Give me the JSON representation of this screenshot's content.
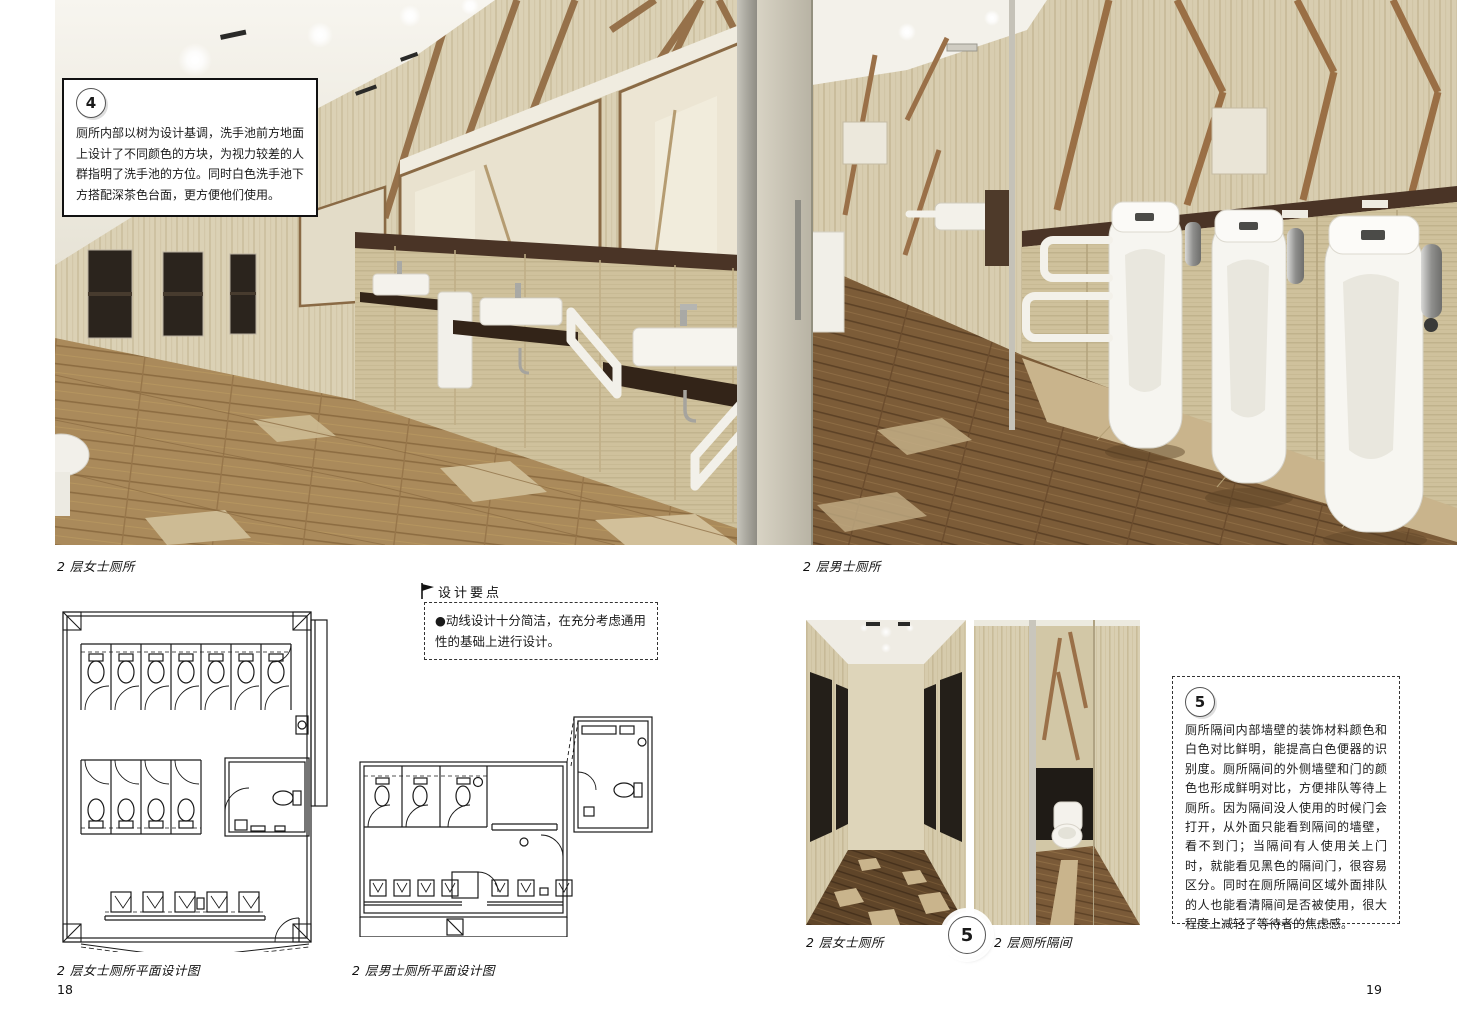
{
  "page": {
    "left_number": "18",
    "right_number": "19"
  },
  "note4": {
    "number": "4",
    "text": "厕所内部以树为设计基调，洗手池前方地面上设计了不同颜色的方块，为视力较差的人群指明了洗手池的方位。同时白色洗手池下方搭配深茶色台面，更方便他们使用。"
  },
  "design_points": {
    "title": "设计要点",
    "bullet": "●动线设计十分简洁，在充分考虑通用性的基础上进行设计。"
  },
  "note5": {
    "number": "5",
    "text": "厕所隔间内部墙壁的装饰材料颜色和白色对比鲜明，能提高白色便器的识别度。厕所隔间的外侧墙壁和门的颜色也形成鲜明对比，方便排队等待上厕所。因为隔间没人使用的时候门会打开，从外面只能看到隔间的墙壁，看不到门；当隔间有人使用关上门时，就能看见黑色的隔间门，很容易区分。同时在厕所隔间区域外面排队的人也能看清隔间是否被使用，很大程度上减轻了等待者的焦虑感。"
  },
  "stamp5": {
    "number": "5"
  },
  "captions": {
    "women_main": "2 层女士厕所",
    "men_main": "2 层男士厕所",
    "women_plan": "2 层女士厕所平面设计图",
    "men_plan": "2 层男士厕所平面设计图",
    "corridor": "2 层女士厕所",
    "stall": "2 层厕所隔间"
  },
  "colors": {
    "wood_light": "#dbd1b5",
    "wood_cabinet": "#cfc19c",
    "wood_branch": "#96714a",
    "counter_dark": "#3a2a1e",
    "rail_dark": "#4a3426",
    "floor_tan": "#aa8a5b",
    "floor_dark": "#6b4c2d",
    "tile_beige": "#cdbb94",
    "stall_door_black": "#241f19"
  }
}
